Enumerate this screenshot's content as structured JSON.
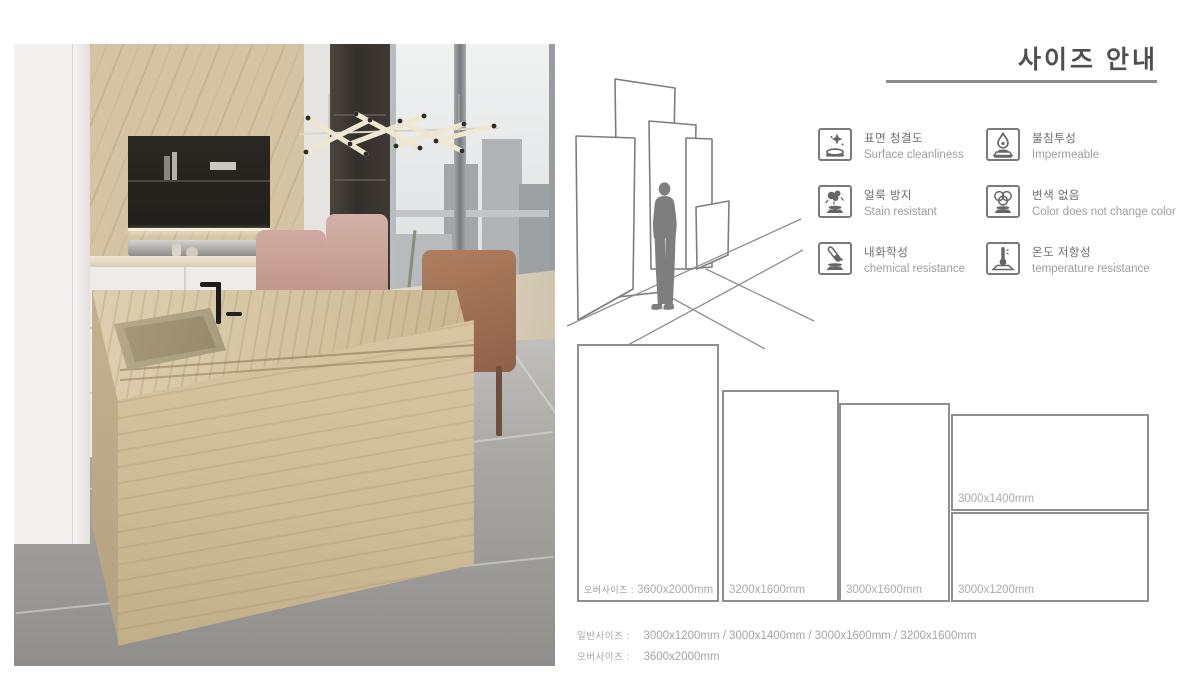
{
  "size_guide": {
    "title": "사이즈 안내",
    "features": [
      {
        "ko": "표면 청결도",
        "en": "Surface cleanliness",
        "icon": "sparkle-surface-icon"
      },
      {
        "ko": "불침투성",
        "en": "Impermeable",
        "icon": "water-drop-icon"
      },
      {
        "ko": "얼룩 방지",
        "en": "Stain resistant",
        "icon": "stain-splash-icon"
      },
      {
        "ko": "변색 없음",
        "en": "Color does not change color",
        "icon": "color-rings-icon"
      },
      {
        "ko": "내화학성",
        "en": "chemical resistance",
        "icon": "test-tube-icon"
      },
      {
        "ko": "온도 저항성",
        "en": "temperature resistance",
        "icon": "thermometer-icon"
      }
    ],
    "panels": [
      {
        "prefix": "오버사이즈 :",
        "size": "3600x2000mm"
      },
      {
        "size": "3200x1600mm"
      },
      {
        "size": "3000x1600mm"
      },
      {
        "size": "3000x1400mm"
      },
      {
        "size": "3000x1200mm"
      }
    ],
    "summary": [
      {
        "label": "일반사이즈 :",
        "value": "3000x1200mm / 3000x1400mm / 3000x1600mm / 3200x1600mm"
      },
      {
        "label": "오버사이즈 :",
        "value": "3600x2000mm"
      }
    ]
  },
  "colors": {
    "title_text": "#4f4f4f",
    "rule_line": "#8a8a8a",
    "panel_outline": "#8f8f8f",
    "label_gray": "#ababab",
    "icon_gray": "#666666"
  }
}
